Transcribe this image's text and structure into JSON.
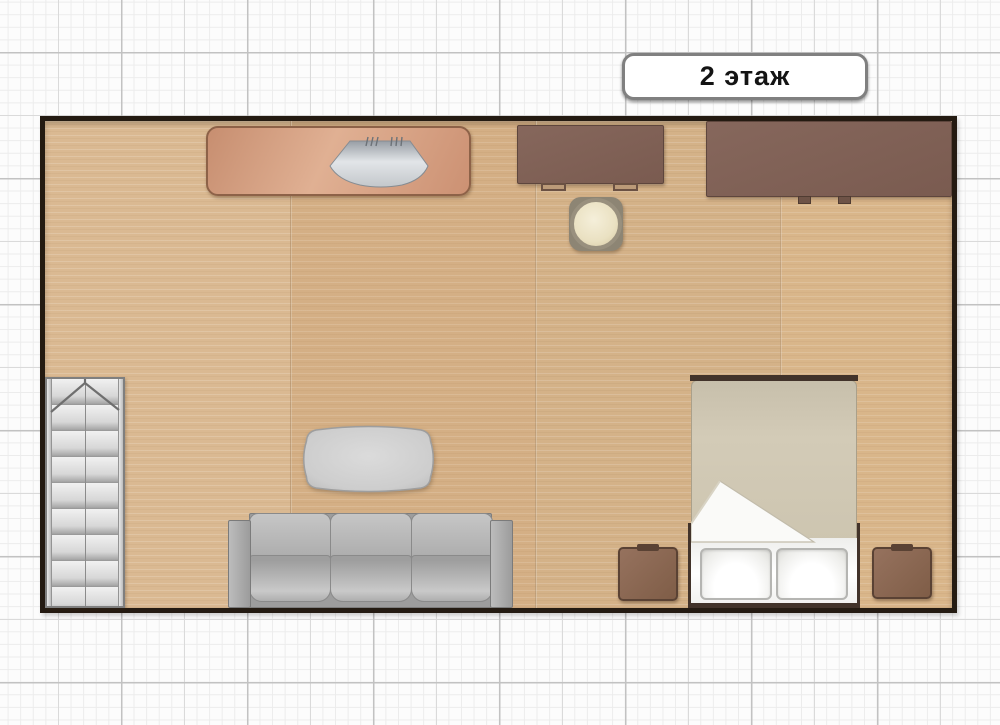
{
  "floor_label": {
    "text": "2 этаж"
  },
  "room": {
    "type": "rectangular",
    "floor_material": "light-wood",
    "furniture": [
      {
        "id": "kitchen-counter",
        "label": "counter with sink"
      },
      {
        "id": "desk-small",
        "label": "desk"
      },
      {
        "id": "desk-large",
        "label": "desk"
      },
      {
        "id": "stool",
        "label": "round stool"
      },
      {
        "id": "staircase",
        "label": "staircase with up arrow"
      },
      {
        "id": "coffee-table",
        "label": "coffee table"
      },
      {
        "id": "sofa",
        "label": "three-seat sofa"
      },
      {
        "id": "bed",
        "label": "double bed with two pillows"
      },
      {
        "id": "nightstand-left",
        "label": "nightstand"
      },
      {
        "id": "nightstand-right",
        "label": "nightstand"
      }
    ]
  },
  "palette": {
    "wall": "#241b12",
    "floor_wood": "#d8b58b",
    "counter_copper": "#d3997b",
    "desk_brown": "#7e6053",
    "nightstand_brown": "#8a6a52",
    "sofa_gray": "#aeaeae",
    "stairs_gray": "#d9d9d9",
    "bed_blanket": "#cdc5b0",
    "pillow_white": "#ffffff",
    "stool_cream": "#ece4ca",
    "grid_paper": "#fcfcfc",
    "label_border": "#808080"
  }
}
